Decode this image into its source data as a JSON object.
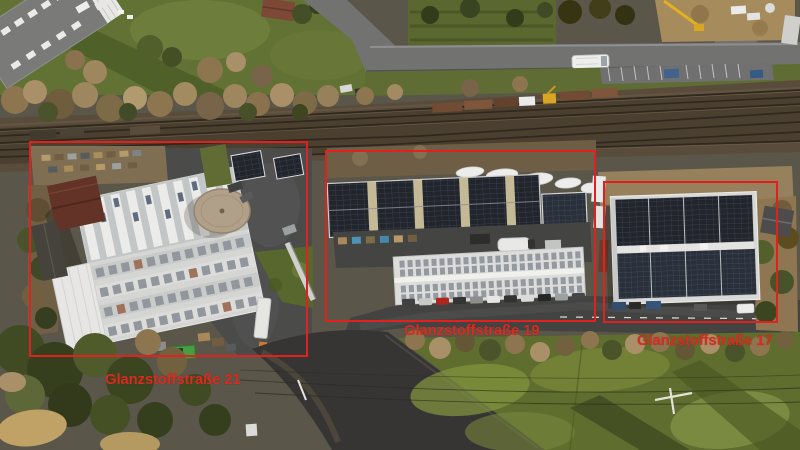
{
  "image": {
    "kind": "aerial-drone-photograph",
    "subject": "industrial buildings with rooftop solar panels along a railway line, winter daylight"
  },
  "annotations": {
    "box_color": "#e2201d",
    "label_color": "#d92b20",
    "boxes": [
      {
        "label": "Glanzstoffstraße 21"
      },
      {
        "label": "Glanzstoffstraße 19"
      },
      {
        "label": "Glanzstoffstraße 17"
      }
    ]
  },
  "scene_features": [
    "railway-tracks",
    "freight-wagons",
    "white-bus-on-road",
    "parking-bays",
    "solar-panel-roofs",
    "white-factory-building",
    "circular-roof-pad",
    "parked-cars-row",
    "green-field",
    "power-lines",
    "construction-crane",
    "residential-houses",
    "winter-trees",
    "asphalt-street"
  ]
}
